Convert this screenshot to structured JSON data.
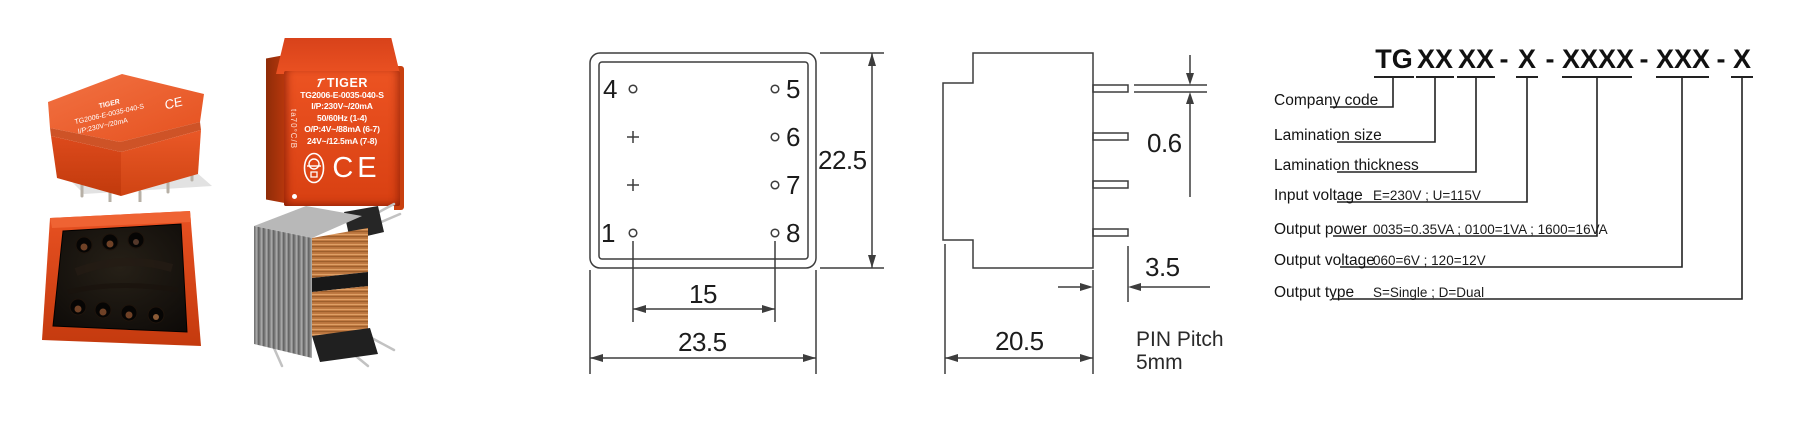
{
  "photos": {
    "front_label": {
      "brand": "TIGER",
      "part_number": "TG2006-E-0035-040-S",
      "line_input": "I/P:230V~/20mA",
      "line_freq": "50/60Hz  (1-4)",
      "line_output1": "O/P:4V~/88mA (6-7)",
      "line_output2": "24V~/12.5mA (7-8)",
      "side_marking": "ta70°C/B",
      "ce_mark": "CE"
    }
  },
  "drawing": {
    "top_view": {
      "pin4": "4",
      "pin1": "1",
      "pin5": "5",
      "pin6": "6",
      "pin7": "7",
      "pin8": "8",
      "dim_height": "22.5",
      "dim_pin_span": "15",
      "dim_width": "23.5"
    },
    "side_view": {
      "dim_pin_thickness": "0.6",
      "dim_pin_length": "3.5",
      "dim_body_depth": "20.5",
      "pin_pitch_line1": "PIN Pitch",
      "pin_pitch_line2": "5mm"
    }
  },
  "part_code": {
    "groups": [
      {
        "text": "TG"
      },
      {
        "text": "XX"
      },
      {
        "text": "XX"
      },
      {
        "text": "-"
      },
      {
        "text": "X"
      },
      {
        "text": "-"
      },
      {
        "text": "XXXX"
      },
      {
        "text": "-"
      },
      {
        "text": "XXX"
      },
      {
        "text": "-"
      },
      {
        "text": "X"
      }
    ],
    "legend": [
      {
        "label": "Company code",
        "value": ""
      },
      {
        "label": "Lamination size",
        "value": ""
      },
      {
        "label": "Lamination thickness",
        "value": ""
      },
      {
        "label": "Input voltage",
        "value": "E=230V ; U=115V"
      },
      {
        "label": "Output power",
        "value": "0035=0.35VA ; 0100=1VA ; 1600=16VA"
      },
      {
        "label": "Output voltage",
        "value": "060=6V ; 120=12V"
      },
      {
        "label": "Output type",
        "value": "S=Single ; D=Dual"
      }
    ]
  },
  "colors": {
    "product_red": "#e2481a",
    "line_color": "#3d3d3d"
  }
}
